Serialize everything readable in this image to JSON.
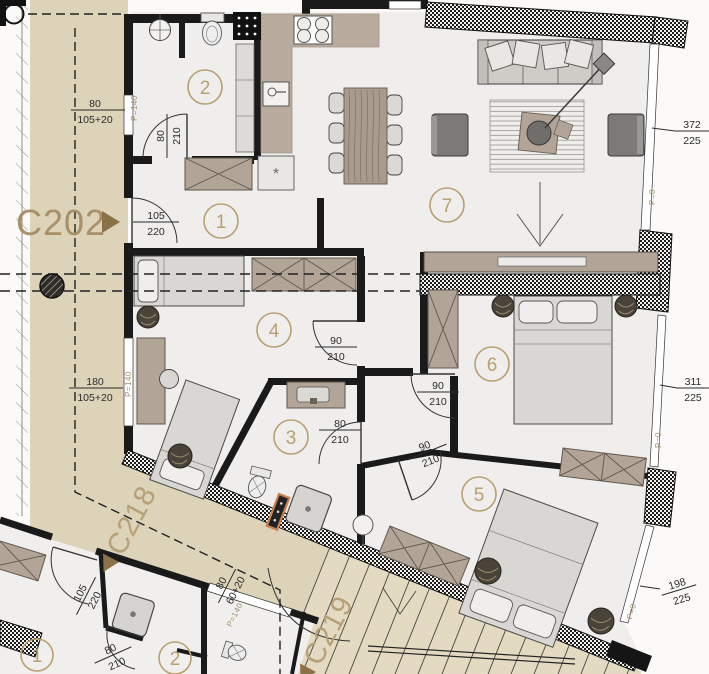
{
  "plan": {
    "units": {
      "c202": "C202",
      "c218": "C218",
      "c219": "C219"
    },
    "room_numbers": [
      "1",
      "2",
      "3",
      "4",
      "5",
      "6",
      "7"
    ],
    "lower_room_numbers": [
      "1",
      "2"
    ],
    "dimensions": [
      {
        "top": "80",
        "bottom": "105+20"
      },
      {
        "top": "105",
        "bottom": "220"
      },
      {
        "top": "80",
        "bottom": "210"
      },
      {
        "top": "180",
        "bottom": "105+20"
      },
      {
        "top": "90",
        "bottom": "210"
      },
      {
        "top": "90",
        "bottom": "210"
      },
      {
        "top": "80",
        "bottom": "210"
      },
      {
        "top": "90",
        "bottom": "210"
      },
      {
        "top": "372",
        "bottom": "225"
      },
      {
        "top": "311",
        "bottom": "225"
      },
      {
        "top": "198",
        "bottom": "225"
      },
      {
        "top": "105",
        "bottom": "220"
      },
      {
        "top": "80",
        "bottom": "210"
      },
      {
        "top": "80",
        "bottom": "60+20"
      }
    ],
    "level_labels": [
      "P=140",
      "P=140",
      "P=140",
      "P=0",
      "P=0",
      "P=0"
    ],
    "symbols": {
      "vent": "*"
    },
    "colors": {
      "wall": "#1a1a1a",
      "corridor": "#ddd3b8",
      "stairs": "#e4dac2",
      "room": "#efeeec",
      "furniture_wood": "#b2a497",
      "furniture_light": "#d9d7d3",
      "dark_seat": "#7b7a76",
      "plant": "#4a4339",
      "accent_label": "#a8916a",
      "dim_text": "#2b2b2b",
      "radiator_accent": "#c97f4f"
    }
  }
}
